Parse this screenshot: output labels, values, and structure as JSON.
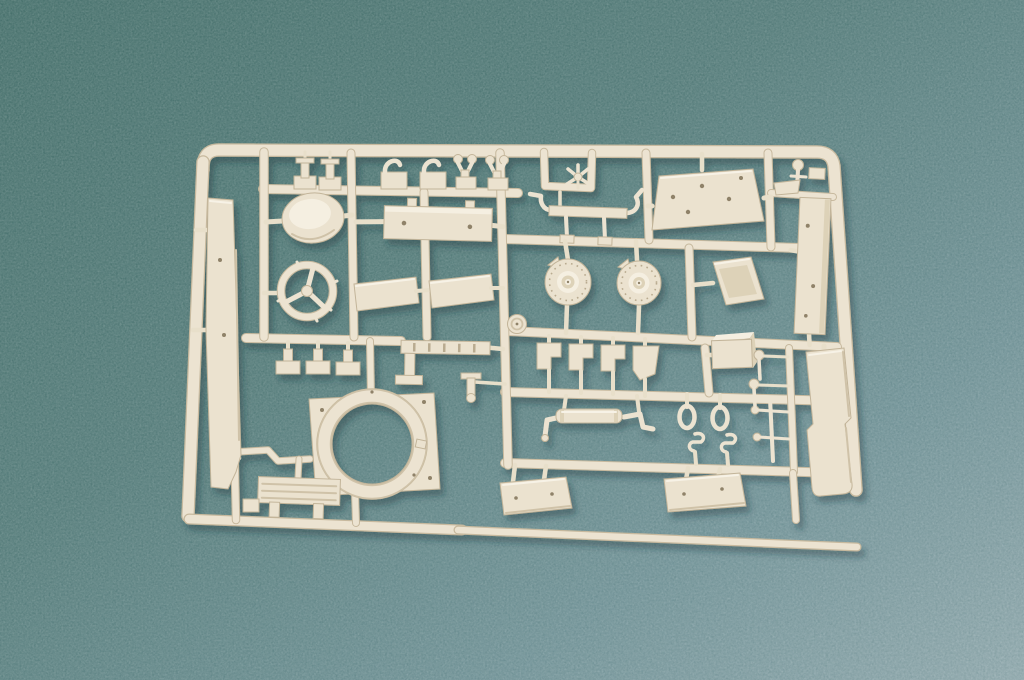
{
  "scene": {
    "description": "Photograph of a single cream-colored injection-molded model kit sprue (parts tree) lying on mottled teal felt",
    "colors": {
      "bg_top_left": "#46706b",
      "bg_mid": "#567d7b",
      "bg_lower": "#74959a",
      "bg_bottom_right": "#95acb1",
      "plastic_base": "#ebe2cf",
      "plastic_light": "#f5efe1",
      "plastic_mid": "#ddd2b8",
      "plastic_edge": "#c2b499",
      "rail_underlay": "#c7b99e",
      "rail_main": "#ece3d1",
      "hole": "#8f8269",
      "shadow": "#16333a"
    },
    "parts": [
      {
        "id": "frame",
        "label": "rectangular sprue frame with rounded corners"
      },
      {
        "id": "long-strip-left",
        "label": "long narrow panel along left rail"
      },
      {
        "id": "oval-hatch-dome",
        "label": "oval domed hatch"
      },
      {
        "id": "slotted-plate",
        "label": "long rectangular plate with holes"
      },
      {
        "id": "linkage-assembly",
        "label": "bar linkage with bent arms"
      },
      {
        "id": "trapezoid-roof-plate",
        "label": "trapezoidal roof plate with holes"
      },
      {
        "id": "long-strip-right",
        "label": "long narrow panel at right"
      },
      {
        "id": "hand-wheel",
        "label": "spoked hand wheel"
      },
      {
        "id": "side-plate-a",
        "label": "small side plate"
      },
      {
        "id": "side-plate-b",
        "label": "small side plate"
      },
      {
        "id": "round-housing-a",
        "label": "round drive housing with hub"
      },
      {
        "id": "round-housing-b",
        "label": "round drive housing with hub"
      },
      {
        "id": "scoop-guard",
        "label": "angled scoop guard"
      },
      {
        "id": "t-brackets",
        "label": "three small T brackets"
      },
      {
        "id": "ladder-rail",
        "label": "slotted ladder rail"
      },
      {
        "id": "turret-ring",
        "label": "large turret ring"
      },
      {
        "id": "ring-base-plate",
        "label": "square base plate with circular opening"
      },
      {
        "id": "grille-bench",
        "label": "slatted grille with legs"
      },
      {
        "id": "hull-plate-front",
        "label": "angled hull plate"
      },
      {
        "id": "hull-plate-rear",
        "label": "angled hull plate"
      },
      {
        "id": "roller-cylinder",
        "label": "cylinder with crank handles"
      },
      {
        "id": "mirror-loops",
        "label": "two oval loop parts"
      },
      {
        "id": "s-hooks",
        "label": "two small hooks"
      },
      {
        "id": "pin-set",
        "label": "thin pins with ball heads"
      },
      {
        "id": "stepped-panel",
        "label": "stepped panel at lower right"
      },
      {
        "id": "small-clips",
        "label": "row of small clips and brackets along top"
      },
      {
        "id": "wishbone-pins",
        "label": "wishbone pins with ball ends"
      },
      {
        "id": "spider-star",
        "label": "small four-arm spider part"
      },
      {
        "id": "gate-disc",
        "label": "small round gate disc"
      },
      {
        "id": "bottom-rail",
        "label": "long thin bottom runner"
      }
    ]
  }
}
